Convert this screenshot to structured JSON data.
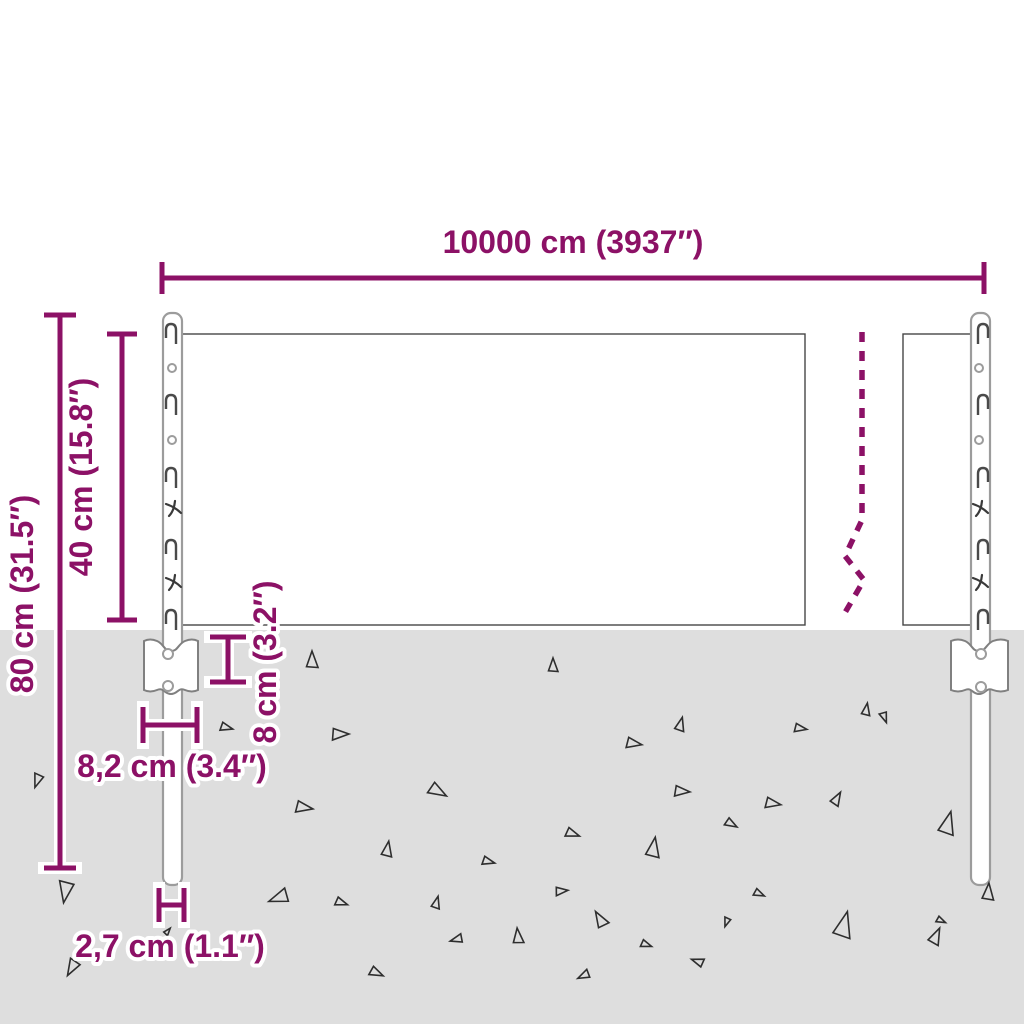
{
  "diagram": {
    "type": "product-dimension-diagram",
    "subject": "wire mesh fence panel with two posts and ground anchor plates",
    "colors": {
      "dimension_accent": "#8C1166",
      "ground": "#DEDEDE",
      "mesh_wire": "#464646",
      "post_outline": "#9C9C9C"
    },
    "labels": {
      "total_width": "10000 cm (3937″)",
      "mesh_height": "40 cm (15.8″)",
      "total_height": "80 cm (31.5″)",
      "anchor_depth": "8 cm (3.2″)",
      "anchor_width": "8,2 cm (3.4″)",
      "post_width": "2,7 cm (1.1″)"
    },
    "ground": {
      "triangles": [
        [
          38,
          779,
          9,
          200
        ],
        [
          66,
          889,
          14,
          190
        ],
        [
          73,
          966,
          11,
          210
        ],
        [
          225,
          727,
          8,
          105
        ],
        [
          167,
          932,
          5,
          40
        ],
        [
          312,
          662,
          11,
          0
        ],
        [
          338,
          734,
          11,
          90
        ],
        [
          302,
          807,
          11,
          100
        ],
        [
          436,
          790,
          12,
          120
        ],
        [
          553,
          667,
          9,
          0
        ],
        [
          571,
          833,
          9,
          110
        ],
        [
          560,
          891,
          8,
          85
        ],
        [
          632,
          743,
          10,
          100
        ],
        [
          680,
          726,
          9,
          15
        ],
        [
          680,
          791,
          10,
          95
        ],
        [
          866,
          711,
          8,
          10
        ],
        [
          884,
          716,
          7,
          160
        ],
        [
          799,
          728,
          8,
          100
        ],
        [
          771,
          803,
          10,
          100
        ],
        [
          836,
          800,
          9,
          30
        ],
        [
          947,
          826,
          15,
          15
        ],
        [
          387,
          851,
          10,
          10
        ],
        [
          487,
          861,
          8,
          105
        ],
        [
          281,
          897,
          13,
          250
        ],
        [
          340,
          902,
          8,
          110
        ],
        [
          436,
          904,
          8,
          15
        ],
        [
          458,
          939,
          8,
          255
        ],
        [
          518,
          938,
          10,
          355
        ],
        [
          375,
          972,
          9,
          115
        ],
        [
          585,
          975,
          8,
          245
        ],
        [
          601,
          921,
          11,
          330
        ],
        [
          653,
          850,
          13,
          10
        ],
        [
          645,
          944,
          7,
          110
        ],
        [
          699,
          962,
          8,
          290
        ],
        [
          730,
          823,
          8,
          120
        ],
        [
          758,
          893,
          7,
          115
        ],
        [
          727,
          921,
          6,
          200
        ],
        [
          843,
          928,
          17,
          15
        ],
        [
          935,
          938,
          11,
          25
        ],
        [
          988,
          894,
          11,
          5
        ],
        [
          940,
          920,
          6,
          115
        ]
      ]
    }
  }
}
